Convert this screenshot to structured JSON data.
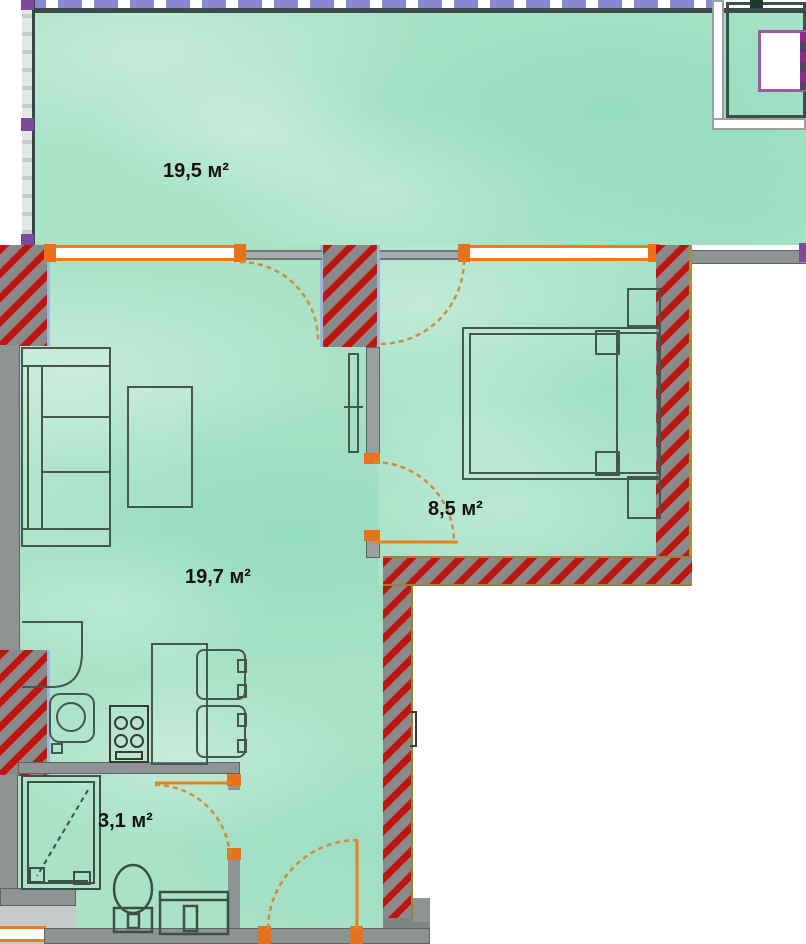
{
  "plan": {
    "title": "apartment-floor-plan",
    "rooms": [
      {
        "name": "terrace",
        "area_label": "19,5 м²"
      },
      {
        "name": "living-room-kitchen",
        "area_label": "19,7 м²"
      },
      {
        "name": "bedroom",
        "area_label": "8,5 м²"
      },
      {
        "name": "bathroom",
        "area_label": "3,1 м²"
      }
    ],
    "colors": {
      "floor_teal": "#a9e2c7",
      "load_wall_hatch_red": "#bf1511",
      "wall_gray": "#8e9393",
      "window_orange": "#ee7c1c",
      "door_swing_orange": "#d4893b",
      "site_boundary_purple": "#8787d2",
      "window_frame_purple": "#a455a4",
      "furniture_outline": "#44584e"
    }
  }
}
